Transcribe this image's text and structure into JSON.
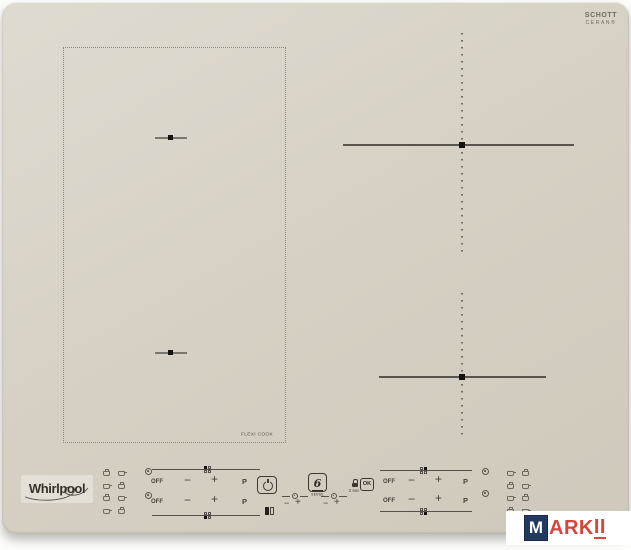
{
  "hob": {
    "brand_logo": "Whirlpool",
    "glass_logo": {
      "line1": "SCHOTT",
      "line2": "CERAN®"
    },
    "flexi_label": "FLEXI COOK",
    "surface_color": "#d7d1c5",
    "line_color": "#55504a"
  },
  "controls": {
    "zones": [
      {
        "position": "left-top",
        "off_label": "OFF",
        "minus_label": "−",
        "plus_label": "+",
        "boost_label": "P"
      },
      {
        "position": "left-bottom",
        "off_label": "OFF",
        "minus_label": "−",
        "plus_label": "+",
        "boost_label": "P"
      },
      {
        "position": "right-top",
        "off_label": "OFF",
        "minus_label": "−",
        "plus_label": "+",
        "boost_label": "P"
      },
      {
        "position": "right-bottom",
        "off_label": "OFF",
        "minus_label": "−",
        "plus_label": "+",
        "boost_label": "P"
      }
    ],
    "center": {
      "six_sense_digit": "6",
      "six_sense_label": "SENSE",
      "lock_hint": "3 sec",
      "ok_label": "OK",
      "timer_minus": "−",
      "timer_plus": "+"
    }
  },
  "icons": {
    "power-icon": "circle with vertical bar",
    "six-sense-icon": "stylized 6",
    "timer-icon": "small dot-in-circle between dashes",
    "lock-icon": "padlock",
    "zone-indicator-icon": "dot-in-circle",
    "cook-function-icon": "mini cookware glyph",
    "display-segment-icon": "two digit segments"
  },
  "watermark": {
    "letter": "M",
    "text_mid": "ARK",
    "text_end": "II",
    "navy": "#223a5e",
    "red": "#d6463e"
  }
}
